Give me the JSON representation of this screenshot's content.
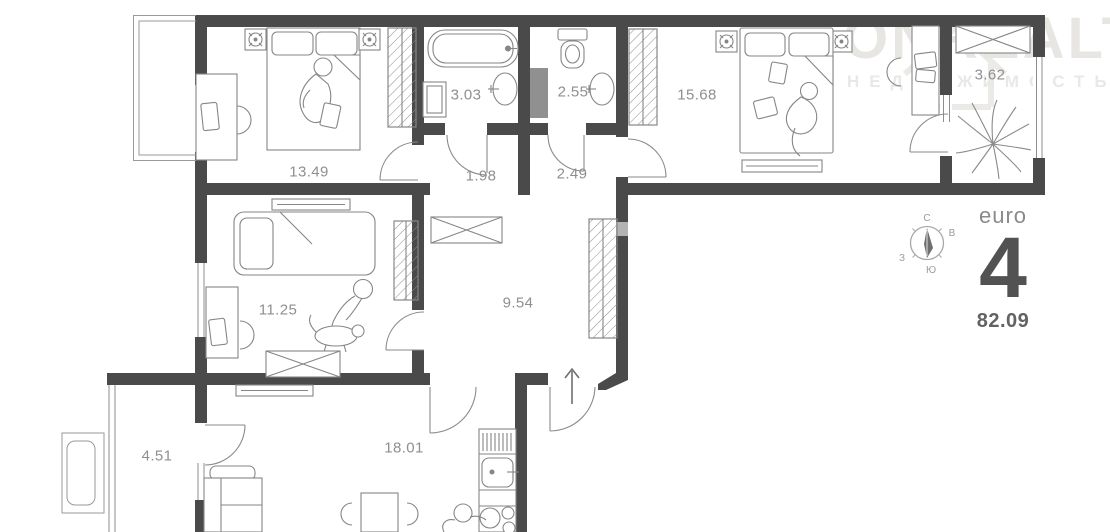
{
  "watermark": {
    "brand": "ONREALT",
    "subtitle": "НЕДВИЖИМОСТЬ"
  },
  "rooms": {
    "bedroom_main": {
      "area": "13.49"
    },
    "bathroom": {
      "area": "3.03"
    },
    "hall_small": {
      "area": "1.98"
    },
    "wc": {
      "area": "2.55"
    },
    "hall_mid": {
      "area": "2.49"
    },
    "bedroom_second": {
      "area": "15.68"
    },
    "balcony_right": {
      "area": "3.62"
    },
    "bedroom_kids": {
      "area": "11.25"
    },
    "corridor": {
      "area": "9.54"
    },
    "kitchen_living": {
      "area": "18.01"
    },
    "balcony_left": {
      "area": "4.51"
    }
  },
  "compass": {
    "north": "С",
    "east": "В",
    "south": "Ю",
    "west": "З"
  },
  "unit_info": {
    "layout_type": "euro",
    "rooms_count": "4",
    "total_area": "82.09"
  },
  "colors": {
    "wall": "#4a4a4a",
    "furniture_line": "#868686",
    "shaft": "#909090"
  }
}
